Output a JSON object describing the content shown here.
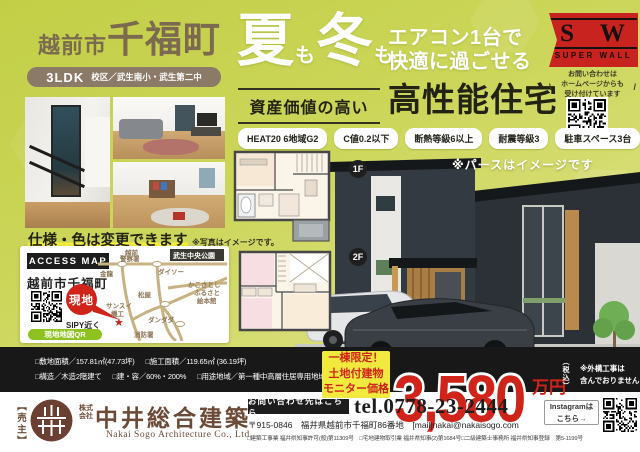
{
  "title_block": {
    "city": "越前市",
    "town": "千福町",
    "ldk": "3LDK",
    "school": "校区／武生南小・武生第二中"
  },
  "headline": {
    "summer": "夏",
    "mo1": "も",
    "winter": "冬",
    "mo2": "も",
    "line1": "エアコン1台で",
    "line2": "快適に過ごせる",
    "sub_label": "資産価値の高い",
    "sub_title": "高性能住宅"
  },
  "superwall": {
    "letters": "S W",
    "brand": "SUPER WALL",
    "note1": "お問い合わせは",
    "note2": "ホームページからも",
    "note3": "受け付けています"
  },
  "badges": [
    "HEAT20 6地域G2",
    "C値0.2以下",
    "断熱等級6以上",
    "耐震等級3",
    "駐車スペース3台"
  ],
  "photo_note": {
    "main": "仕様・色は変更できます",
    "sub": "※写真はイメージです。"
  },
  "floor": {
    "f1": "1F",
    "f2": "2F",
    "note": "※パースはイメージです"
  },
  "map": {
    "title": "ACCESS MAP",
    "town": "越前市千福町",
    "site": "現地",
    "near": "SIPY近く",
    "qr_label": "現地地図QR",
    "police1": "越前",
    "police2": "警察署",
    "park": "武生中央公園",
    "kinryu": "金龍",
    "daiso": "ダイソー",
    "ehonkan1": "かこさとし",
    "ehonkan2": "ふるさと",
    "ehonkan3": "絵本館",
    "matsuya": "松屋",
    "sansui1": "サンスイ",
    "sansui2": "機工",
    "dandada": "ダンダダ",
    "fire": "消防署",
    "star": "★"
  },
  "specs": {
    "r1a": "□敷地面積／157.81㎡(47.73坪)",
    "r1b": "□施工面積／119.65㎡ (36.19坪)",
    "r2a": "□構造／木造2階建て",
    "r2b": "□建・容／60%・200%",
    "r2c": "□用途地域／第一種中高層住居専用地域"
  },
  "price": {
    "tag1": "一棟限定！",
    "tag2": "土地付建物",
    "tag3": "モニター価格",
    "amount": "3,580",
    "unit": "万円",
    "tax": "（税込）",
    "note1": "※外構工事は",
    "note2": "含んでおりません"
  },
  "footer": {
    "seller": "【売主】",
    "corp1": "株式",
    "corp2": "会社",
    "name": "中井総合建築",
    "name_en": "Nakai Sogo Architecture Co., Ltd.",
    "contact": "お問い合わせ先はこちら",
    "tel": "tel.0778-23-2444",
    "address": "〒915-0846　福井県越前市千福町86番地　[mail]nakai@nakaisogo.com",
    "license": "□建築工事業 福井県知事許可(般)第11309号　□宅地建物取引業 福井県知事(2)第1684号□二級建築士事務所 福井県知事登録　第5-1199号",
    "insta1": "Instagramは",
    "insta2": "こちら→"
  },
  "colors": {
    "background": "#ccd65a",
    "brown_text": "#7b6950",
    "ribbon_red": "#c8231e",
    "price_red": "#d0241b",
    "tag_yellow": "#f2e93e",
    "map_qr_green": "#8dc21f",
    "strip_black": "#181818",
    "company_brown": "#6b4a38"
  }
}
